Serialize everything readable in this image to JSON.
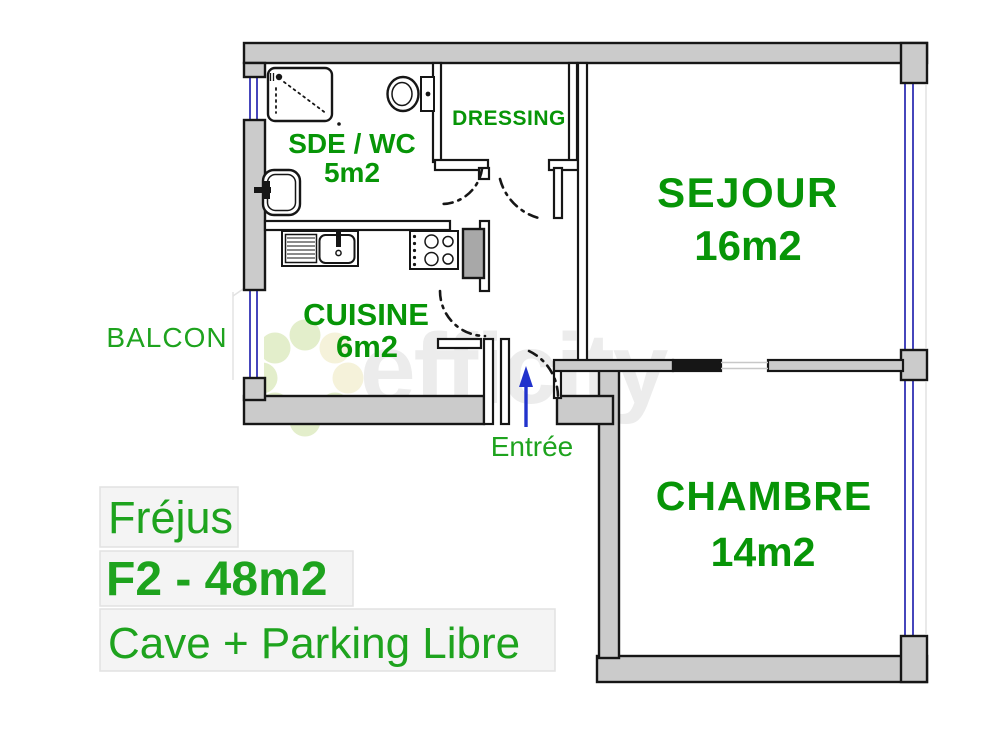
{
  "floorplan": {
    "rooms": [
      {
        "name": "SDE / WC",
        "area": "5m2"
      },
      {
        "name": "DRESSING",
        "area": ""
      },
      {
        "name": "SEJOUR",
        "area": "16m2"
      },
      {
        "name": "CUISINE",
        "area": "6m2"
      },
      {
        "name": "CHAMBRE",
        "area": "14m2"
      }
    ],
    "balcony_label": "BALCON",
    "entrance_label": "Entrée"
  },
  "caption": {
    "line1": "Fréjus",
    "line2": "F2 - 48m2",
    "line3": "Cave + Parking Libre"
  },
  "watermark": {
    "text": "efficity"
  },
  "colors": {
    "room_label_green": "#079507",
    "caption_green": "#1ea31e",
    "wall_gray": "#cbcbcb",
    "wall_outline": "#161616",
    "window_blue": "#3232b4",
    "arrow_blue": "#2233cc",
    "watermark_gray": "#ececec",
    "watermark_dot_green": "#e3eecb",
    "watermark_dot_cream": "#f5f2da",
    "caption_box_bg": "#f4f4f4",
    "caption_box_border": "#e2e2e2"
  }
}
